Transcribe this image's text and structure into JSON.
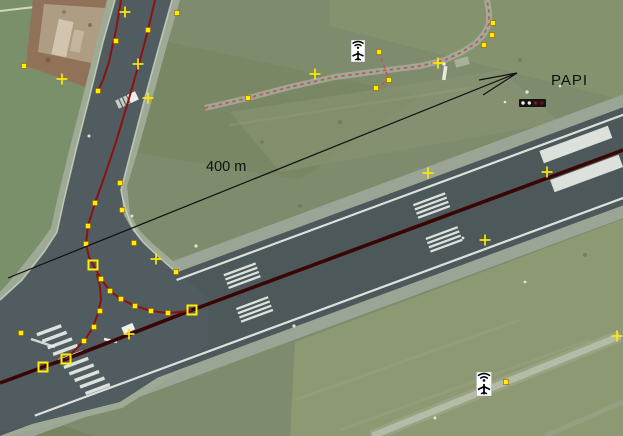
{
  "annotation": {
    "distance_label": "400 m",
    "papi_label": "PAPI"
  },
  "colors": {
    "way": "#8c1212",
    "runway_centerline": "#3a0505",
    "node_fill": "#ffee00",
    "node_border": "#9a5a00",
    "plus_marker": "#ffe800",
    "trail_dash": "#c5525f",
    "arrow": "#111111",
    "papi_box": "#141414"
  },
  "overlay": {
    "ways": [
      {
        "name": "runway-centerline-way",
        "color": "#3a0505",
        "width": 3.6,
        "points": [
          [
            0,
            383
          ],
          [
            43,
            367
          ],
          [
            66,
            359
          ],
          [
            192,
            310
          ],
          [
            623,
            150
          ]
        ]
      },
      {
        "name": "taxiway-centerline-way",
        "color": "#8c1212",
        "width": 2,
        "points": [
          [
            155,
            0
          ],
          [
            148,
            30
          ],
          [
            140,
            60
          ],
          [
            128,
            102
          ],
          [
            116,
            142
          ],
          [
            105,
            175
          ],
          [
            95,
            203
          ],
          [
            88,
            226
          ],
          [
            86,
            244
          ],
          [
            89,
            257
          ],
          [
            95,
            268
          ],
          [
            101,
            279
          ],
          [
            110,
            291
          ],
          [
            121,
            299
          ],
          [
            135,
            306
          ],
          [
            151,
            311
          ],
          [
            168,
            313
          ],
          [
            180,
            312
          ],
          [
            192,
            310
          ]
        ]
      },
      {
        "name": "taxiway-branch-way",
        "color": "#8c1212",
        "width": 2,
        "points": [
          [
            97,
            274
          ],
          [
            100,
            287
          ],
          [
            101,
            300
          ],
          [
            98,
            313
          ],
          [
            93,
            327
          ],
          [
            85,
            340
          ],
          [
            75,
            350
          ],
          [
            66,
            359
          ]
        ]
      },
      {
        "name": "dirt-edge-way",
        "color": "#8c1212",
        "width": 2,
        "points": [
          [
            121,
            0
          ],
          [
            116,
            30
          ],
          [
            109,
            62
          ],
          [
            103,
            80
          ],
          [
            98,
            91
          ]
        ]
      },
      {
        "name": "trail-way",
        "color": "#c5525f",
        "width": 1.7,
        "dash": "3.5,3.5",
        "points": [
          [
            205,
            108
          ],
          [
            248,
            98
          ],
          [
            290,
            87
          ],
          [
            335,
            77
          ],
          [
            380,
            71
          ],
          [
            420,
            66
          ],
          [
            445,
            60
          ],
          [
            462,
            52
          ],
          [
            476,
            43
          ],
          [
            484,
            34
          ],
          [
            489,
            24
          ],
          [
            489,
            12
          ],
          [
            487,
            0
          ]
        ]
      },
      {
        "name": "trail-spur-way",
        "color": "#c5525f",
        "width": 1.7,
        "dash": "3.5,3.5",
        "points": [
          [
            379,
            52
          ],
          [
            389,
            80
          ],
          [
            376,
            88
          ]
        ]
      }
    ],
    "nodes_small": [
      [
        148,
        30
      ],
      [
        116,
        41
      ],
      [
        98,
        91
      ],
      [
        24,
        66
      ],
      [
        177,
        13
      ],
      [
        95,
        203
      ],
      [
        88,
        226
      ],
      [
        86,
        244
      ],
      [
        101,
        279
      ],
      [
        110,
        291
      ],
      [
        121,
        299
      ],
      [
        135,
        306
      ],
      [
        151,
        311
      ],
      [
        168,
        313
      ],
      [
        100,
        311
      ],
      [
        94,
        327
      ],
      [
        84,
        341
      ],
      [
        120,
        183
      ],
      [
        122,
        210
      ],
      [
        134,
        243
      ],
      [
        176,
        272
      ],
      [
        21,
        333
      ],
      [
        248,
        98
      ],
      [
        379,
        52
      ],
      [
        389,
        80
      ],
      [
        376,
        88
      ],
      [
        484,
        45
      ],
      [
        492,
        35
      ],
      [
        493,
        23
      ],
      [
        506,
        382
      ]
    ],
    "nodes_large": [
      [
        93,
        265
      ],
      [
        192,
        310
      ],
      [
        66,
        359
      ],
      [
        43,
        367
      ]
    ],
    "plus_markers": [
      [
        125,
        12
      ],
      [
        62,
        79
      ],
      [
        138,
        64
      ],
      [
        148,
        98
      ],
      [
        315,
        74
      ],
      [
        438,
        63
      ],
      [
        428,
        173
      ],
      [
        547,
        172
      ],
      [
        485,
        240
      ],
      [
        156,
        259
      ],
      [
        129,
        334
      ],
      [
        617,
        336
      ]
    ],
    "icons": [
      {
        "name": "navaid-airplane-icon",
        "x": 358,
        "y": 51,
        "scale": 1.0
      },
      {
        "name": "navaid-airplane-icon",
        "x": 484,
        "y": 384,
        "scale": 1.1
      }
    ],
    "papi_unit": {
      "name": "papi-lights",
      "x": 519,
      "y": 99,
      "w": 27,
      "h": 8,
      "lights": [
        "#f4f4f4",
        "#ececec",
        "#8c1616",
        "#701010"
      ]
    }
  }
}
